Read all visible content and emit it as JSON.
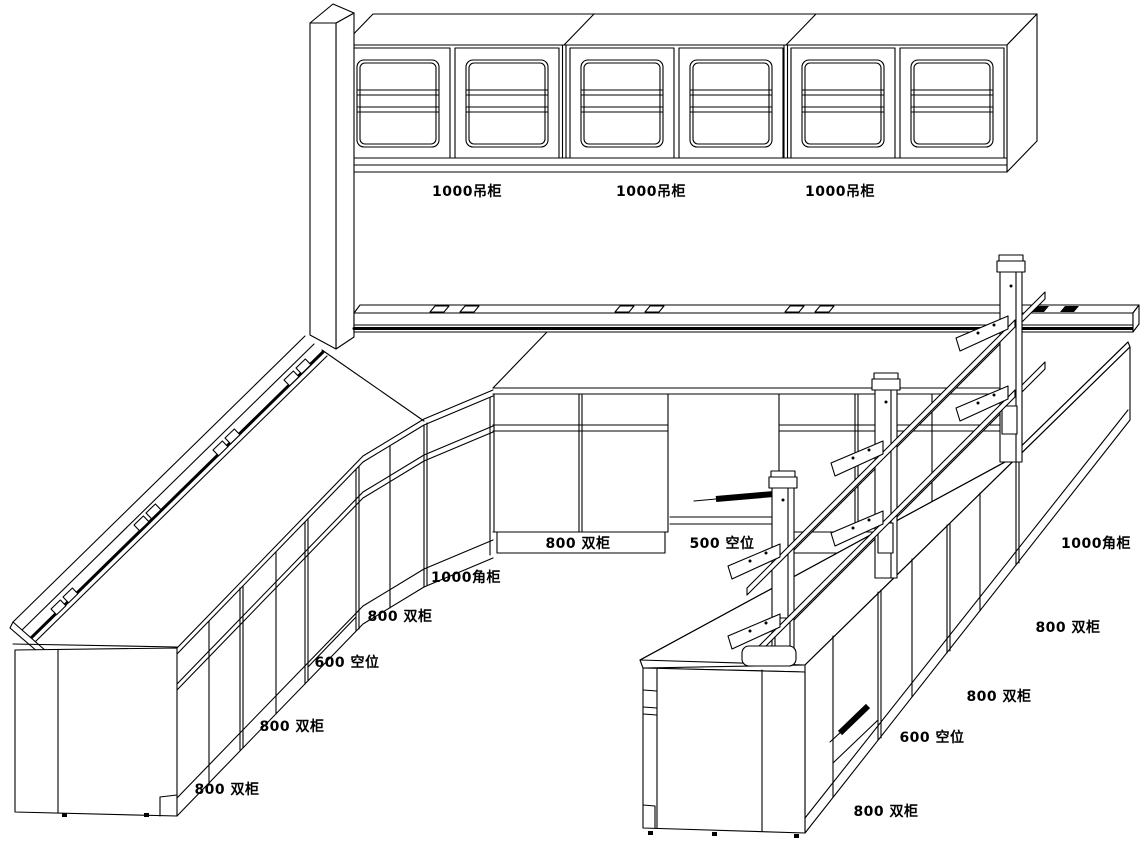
{
  "colors": {
    "background": "#ffffff",
    "line": "#000000",
    "text": "#000000"
  },
  "labels": {
    "wall_cabinets": [
      {
        "text": "1000吊柜"
      },
      {
        "text": "1000吊柜"
      },
      {
        "text": "1000吊柜"
      }
    ],
    "back_bench": [
      {
        "text": "800 双柜"
      },
      {
        "text": "500 空位"
      }
    ],
    "left_bench": [
      {
        "text": "1000角柜"
      },
      {
        "text": "800 双柜"
      },
      {
        "text": "600 空位"
      },
      {
        "text": "800 双柜"
      },
      {
        "text": "800 双柜"
      }
    ],
    "island_bench": [
      {
        "text": "1000角柜"
      },
      {
        "text": "800 双柜"
      },
      {
        "text": "800 双柜"
      },
      {
        "text": "600 空位"
      },
      {
        "text": "800 双柜"
      }
    ]
  }
}
